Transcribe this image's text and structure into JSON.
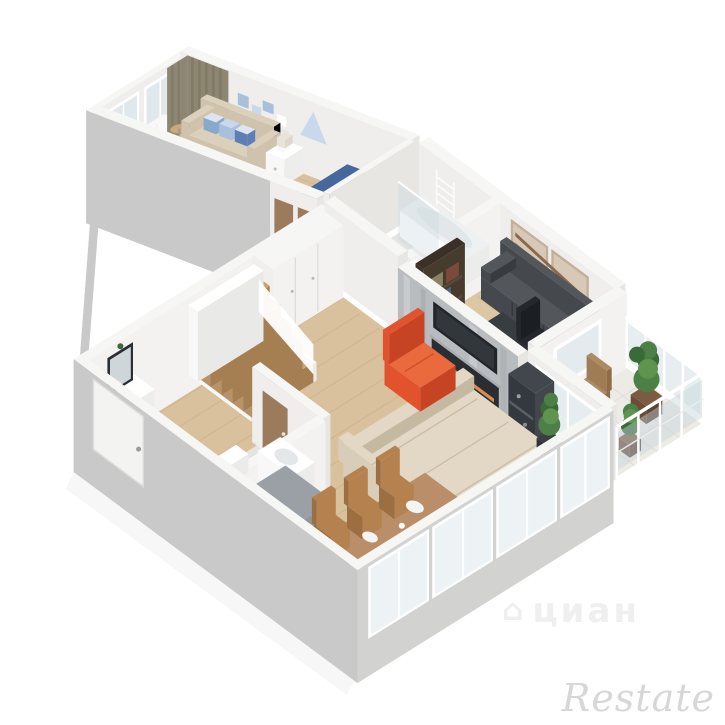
{
  "image": {
    "kind": "3d-floorplan-render",
    "style": "isometric cutaway apartment",
    "background": "#ffffff"
  },
  "watermarks": {
    "portal": "циан",
    "portal_icon": "house-icon",
    "brand": "Restate"
  },
  "palette": {
    "extWall": "#c9c9c9",
    "extWall2": "#d2d2d0",
    "wallTop": "#f6f6f5",
    "intWall": "#efeeec",
    "intWallSide": "#e7e6e3",
    "intWallLit": "#f3f2f0",
    "woodFloor": "#d9c19e",
    "woodLine": "#c2a47c",
    "woodFloor2": "#dcc6a4",
    "tile": "#e4e4e1",
    "tileBal": "#edebe6",
    "tileLine": "#dcdad3",
    "glass": "#dfe8ec",
    "glassRail": "#c5d4da",
    "frame": "#ffffff",
    "curtain": "#8d8672",
    "curtainFold": "#767055",
    "sofaBeige": "#cfc3ae",
    "sofaBeigeTop": "#dbd0bc",
    "bedBlue": "#5d7fb5",
    "bedBlueDark": "#46689e",
    "pillowLight": "#dce6f2",
    "white": "#f8f8f8",
    "whitePure": "#ffffff",
    "crib": "#f4f4f3",
    "cribIn": "#f7fafc",
    "rugPlay": "#e7decd",
    "toyYellow": "#e6c23c",
    "toyRed": "#d8764a",
    "toyBlue": "#6a98d0",
    "starBlue": "#5d87c0",
    "decorBlue1": "#a8c0dc",
    "decorBlue2": "#88a8cc",
    "decorBlue3": "#c9d8ea",
    "sectional": "#d8cdb8",
    "sectionalTop": "#e2d8c5",
    "sectionalShade": "#c6b9a1",
    "seam": "#c3b59c",
    "rugLiving": "#eae7e3",
    "rugDot": "#d8d2cd",
    "orange": "#e2522c",
    "orangeTop": "#ea6a3e",
    "orangeDark": "#c64423",
    "marble": "#b9bcbe",
    "marbleLight": "#cdd0d2",
    "marbleDark": "#a0a4a7",
    "tv": "#22262a",
    "tvIn": "#32373c",
    "fire": "#2a2e32",
    "ember": "#d98b52",
    "mantel": "#aaadaf",
    "media": "#42474d",
    "mediaDark": "#343940",
    "mediaLine": "#5a6067",
    "darkSofa": "#45494e",
    "darkSofaTop": "#53575c",
    "darkSofaShade": "#383c40",
    "desk": "#7b523b",
    "deskFront": "#5f3e2d",
    "deskDrawer": "#33383d",
    "chairBlack": "#24282c",
    "chairBlackD": "#1b1f23",
    "shelfWood": "#3a3028",
    "shelfSide": "#473b2e",
    "shelfLine": "#584a3c",
    "book1": "#7a4a3a",
    "book2": "#51617e",
    "book3": "#8a8262",
    "artPanel": "#d8c9b6",
    "artFrame": "#c2b09a",
    "artSwash": "#8a6950",
    "artSwash2": "#b79a7c",
    "tableWood": "#b98e68",
    "tableFront": "#a07a56",
    "chairWood": "#b5824f",
    "chairWoodDark": "#9c6f42",
    "plate": "#f4f4f2",
    "grayCab": "#9aa0a6",
    "grayCabFront": "#868c93",
    "grayCabIn": "#60666d",
    "steel": "#8f959b",
    "plantGreen": "#4c8046",
    "plantDark": "#3a6a38",
    "plantLight": "#5f944f",
    "pot": "#7d5a42",
    "potFront": "#6b4c36",
    "potDark": "#2f3336",
    "balChair": "#a07c55",
    "balChairTop": "#ac8a62",
    "balChairSide": "#8f6c48",
    "doorBrown": "#9b7b5c",
    "mirror": "#2b2e33",
    "mirrorGlass": "#cfd6da",
    "radiator": "#f9f9f8",
    "towel": "#fbfbfa",
    "duvetFold": "#4a6b9f",
    "basin": "#e3e7e8"
  },
  "rooms": [
    {
      "name": "bedroom-nursery",
      "furniture": [
        "sofa-with-pillows",
        "child-bed-blue",
        "white-crib",
        "canopy",
        "nightstand",
        "table-round",
        "curtains",
        "windows",
        "radiator",
        "wall-decor-marine",
        "play-rug",
        "toys"
      ]
    },
    {
      "name": "corridor",
      "furniture": [
        "interior-door",
        "interior-door"
      ]
    },
    {
      "name": "bathroom",
      "furniture": [
        "bathtub",
        "toilet",
        "sink-counter",
        "glass-screen",
        "towel-radiator"
      ]
    },
    {
      "name": "office-lounge",
      "furniture": [
        "leather-sofa-dark",
        "wall-art-diptych",
        "corner-desk",
        "office-chair",
        "bookshelf",
        "coffee-table"
      ]
    },
    {
      "name": "living-room",
      "furniture": [
        "orange-armchair",
        "corner-sofa-beige",
        "fluffy-rug",
        "marble-tv-wall-fireplace",
        "media-shelf",
        "potted-plant",
        "staircase",
        "wardrobe-closets"
      ]
    },
    {
      "name": "dining-area",
      "furniture": [
        "wooden-table",
        "wooden-chairs",
        "plates",
        "panoramic-windows"
      ]
    },
    {
      "name": "hallway",
      "furniture": [
        "entry-door",
        "mirror",
        "console",
        "gray-cabinet"
      ]
    },
    {
      "name": "wc",
      "furniture": [
        "washing-machine",
        "vanity-sink",
        "toilet",
        "interior-door"
      ]
    },
    {
      "name": "balcony",
      "furniture": [
        "glazed-railing",
        "plants",
        "armchair-tan"
      ]
    }
  ]
}
